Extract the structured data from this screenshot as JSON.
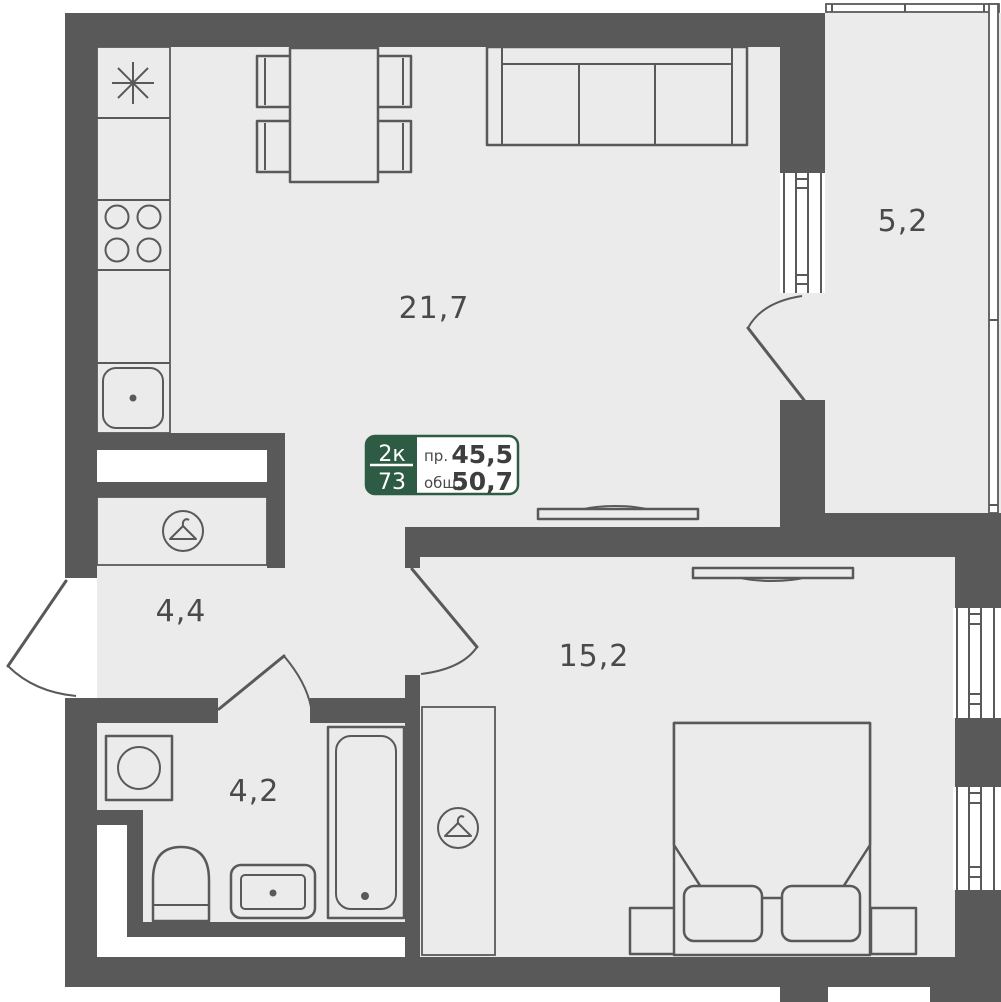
{
  "badge": {
    "rooms_type": "2к",
    "unit_number": "73",
    "living_area_label": "пр.",
    "living_area_value": "45,5",
    "total_area_label": "общ.",
    "total_area_value": "50,7"
  },
  "areas": {
    "living_kitchen": "21,7",
    "balcony": "5,2",
    "hallway": "4,4",
    "bedroom": "15,2",
    "bathroom": "4,2"
  },
  "colors": {
    "wall": "#595959",
    "floor": "#EBEBEB",
    "outside": "#FFFFFF",
    "badge_green": "#2E5B44",
    "label_text": "#4A4A4A"
  },
  "icons": {
    "fridge": "snowflake-asterisk",
    "stove": "four-burner-circles",
    "kitchen_sink": "rounded-square-drain",
    "closet": "hanger-in-circle",
    "wardrobe": "hanger-in-circle",
    "washing_machine": "square-with-drum-circle",
    "toilet": "arched-bowl",
    "bath_sink": "oval-basin",
    "bathtub": "long-tub-with-drain",
    "tv": "flat-panel-with-mount"
  }
}
